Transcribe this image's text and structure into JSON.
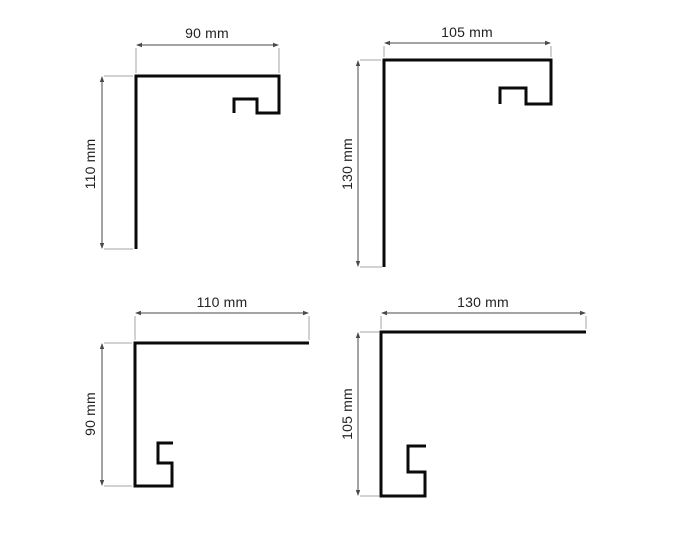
{
  "page": {
    "background": "#ffffff",
    "width": 675,
    "height": 540
  },
  "drawing": {
    "type": "technical-dimension-drawing",
    "subject": "corner-edge-profiles",
    "units": "mm",
    "line_colors": {
      "profile": "#0a0a0a",
      "dimension": "#4a4a4a",
      "extension": "#a6a6a6",
      "text": "#222222"
    },
    "figures": [
      {
        "name": "corner-profile-90x110",
        "width_mm": 90,
        "height_mm": 110,
        "width_label": "90 mm",
        "height_label": "110 mm",
        "profile_points": [
          [
            136,
            249
          ],
          [
            136,
            76
          ],
          [
            279,
            76
          ],
          [
            279,
            113
          ],
          [
            257,
            113
          ],
          [
            257,
            99
          ],
          [
            234,
            99
          ],
          [
            234,
            113
          ]
        ],
        "h_dim": {
          "y": 45,
          "x1": 136,
          "x2": 279,
          "label_x": 207,
          "label_y": 33
        },
        "v_dim": {
          "x": 102,
          "y1": 76,
          "y2": 249,
          "label_x": 90,
          "label_y": 164
        },
        "extension_lines": [
          [
            136,
            48,
            136,
            73
          ],
          [
            279,
            48,
            279,
            73
          ],
          [
            104,
            76,
            133,
            76
          ],
          [
            104,
            249,
            133,
            249
          ]
        ]
      },
      {
        "name": "corner-profile-105x130",
        "width_mm": 105,
        "height_mm": 130,
        "width_label": "105 mm",
        "height_label": "130 mm",
        "profile_points": [
          [
            384,
            267
          ],
          [
            384,
            60
          ],
          [
            551,
            60
          ],
          [
            551,
            104
          ],
          [
            526,
            104
          ],
          [
            526,
            88
          ],
          [
            500,
            88
          ],
          [
            500,
            104
          ]
        ],
        "h_dim": {
          "y": 43,
          "x1": 384,
          "x2": 551,
          "label_x": 467,
          "label_y": 32
        },
        "v_dim": {
          "x": 358,
          "y1": 60,
          "y2": 267,
          "label_x": 347,
          "label_y": 164
        },
        "extension_lines": [
          [
            384,
            46,
            384,
            57
          ],
          [
            551,
            46,
            551,
            57
          ],
          [
            360,
            60,
            381,
            60
          ],
          [
            360,
            267,
            382,
            267
          ]
        ]
      },
      {
        "name": "corner-profile-110x90",
        "width_mm": 110,
        "height_mm": 90,
        "width_label": "110 mm",
        "height_label": "90 mm",
        "profile_points": [
          [
            309,
            343
          ],
          [
            135,
            343
          ],
          [
            135,
            486
          ],
          [
            172,
            486
          ],
          [
            172,
            463
          ],
          [
            158,
            463
          ],
          [
            158,
            443
          ],
          [
            173,
            443
          ]
        ],
        "h_dim": {
          "y": 313,
          "x1": 135,
          "x2": 309,
          "label_x": 222,
          "label_y": 302
        },
        "v_dim": {
          "x": 102,
          "y1": 343,
          "y2": 486,
          "label_x": 90,
          "label_y": 414
        },
        "extension_lines": [
          [
            135,
            316,
            135,
            340
          ],
          [
            309,
            316,
            309,
            340
          ],
          [
            104,
            343,
            132,
            343
          ],
          [
            104,
            486,
            132,
            486
          ]
        ]
      },
      {
        "name": "corner-profile-130x105",
        "width_mm": 130,
        "height_mm": 105,
        "width_label": "130 mm",
        "height_label": "105 mm",
        "profile_points": [
          [
            586,
            332
          ],
          [
            381,
            332
          ],
          [
            381,
            496
          ],
          [
            425,
            496
          ],
          [
            425,
            472
          ],
          [
            408,
            472
          ],
          [
            408,
            446
          ],
          [
            426,
            446
          ]
        ],
        "h_dim": {
          "y": 313,
          "x1": 381,
          "x2": 586,
          "label_x": 483,
          "label_y": 302
        },
        "v_dim": {
          "x": 358,
          "y1": 332,
          "y2": 496,
          "label_x": 347,
          "label_y": 414
        },
        "extension_lines": [
          [
            381,
            316,
            381,
            329
          ],
          [
            586,
            316,
            586,
            329
          ],
          [
            360,
            332,
            379,
            332
          ],
          [
            360,
            496,
            379,
            496
          ]
        ]
      }
    ]
  }
}
